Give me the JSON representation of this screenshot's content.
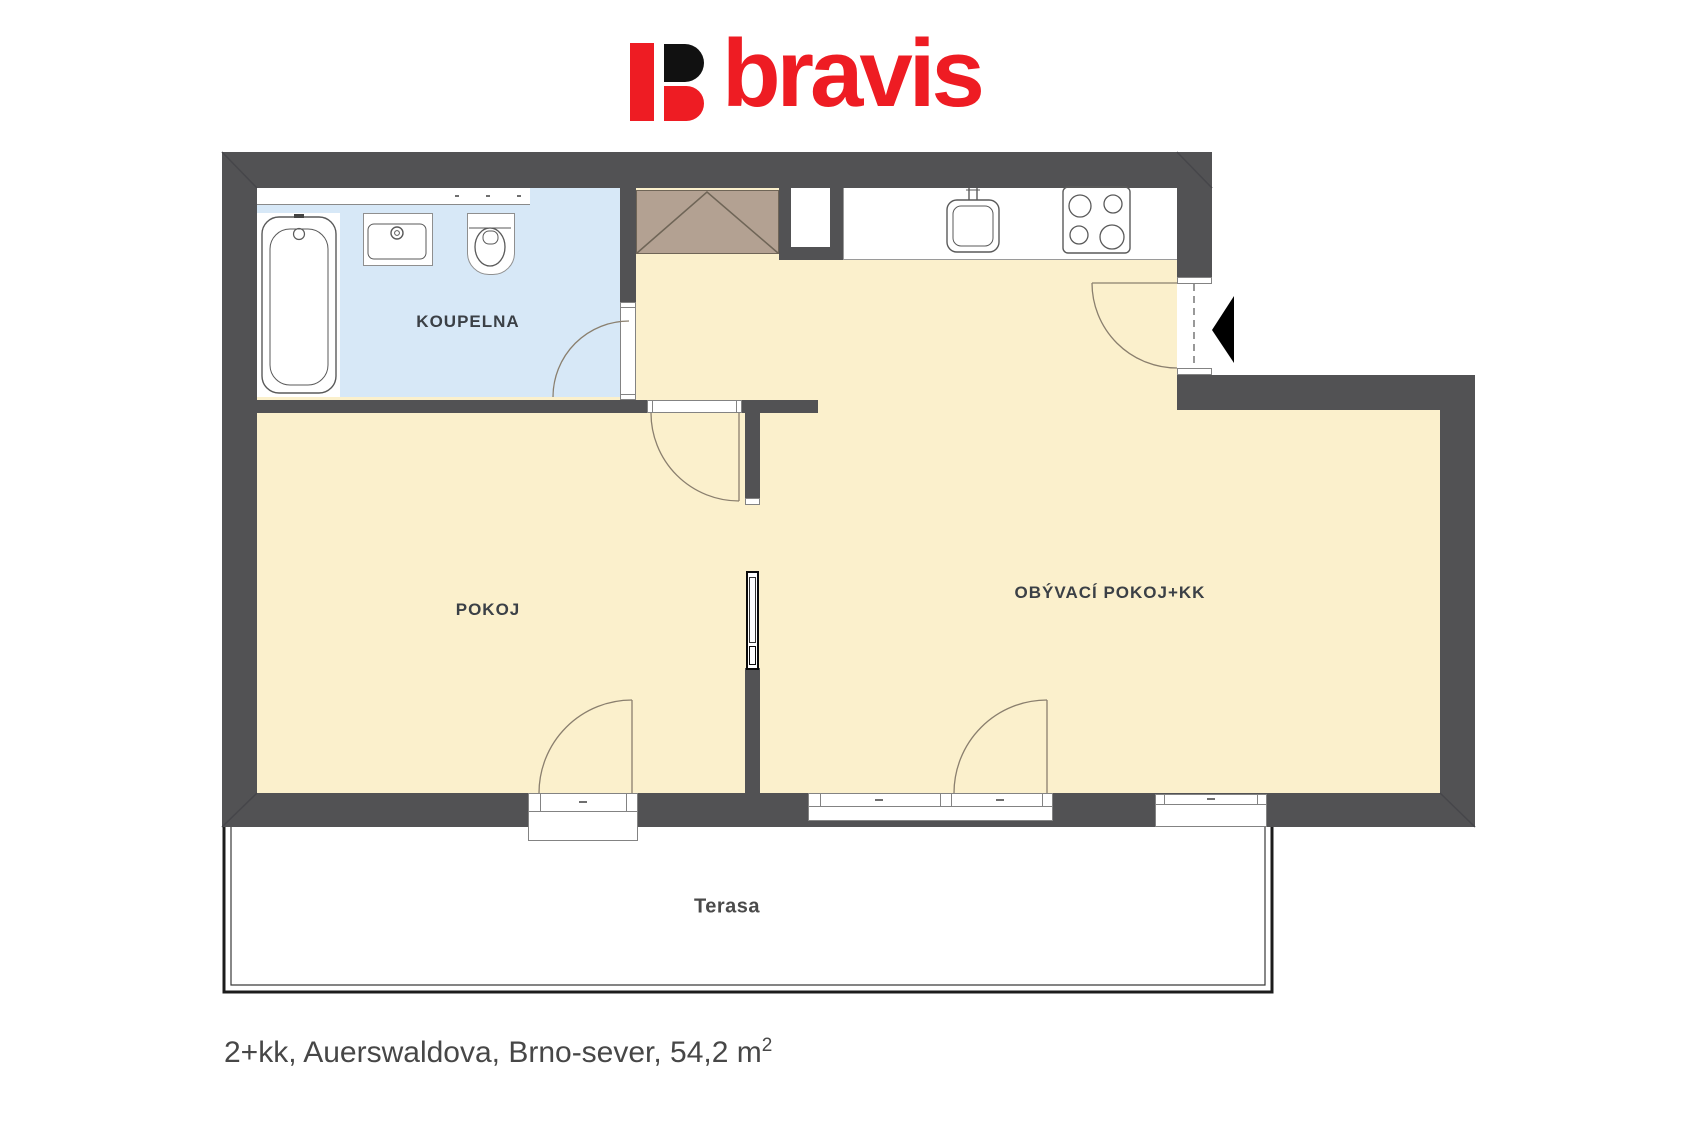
{
  "logo": {
    "text": "bravis",
    "brand_red": "#ee1c23",
    "mark_black": "#111111"
  },
  "rooms": {
    "bathroom": "KOUPELNA",
    "bedroom": "POKOJ",
    "living_kitchen": "OBÝVACÍ POKOJ+KK",
    "terrace": "Terasa"
  },
  "caption": {
    "text": "2+kk, Auerswaldova, Brno-sever, 54,2 m",
    "superscript": "2"
  },
  "colors": {
    "wall": "#525254",
    "floor": "#fbf0cc",
    "bathroom_floor": "#d7e8f7",
    "wardrobe": "#b3a192",
    "entrance_arrow": "#000000"
  }
}
